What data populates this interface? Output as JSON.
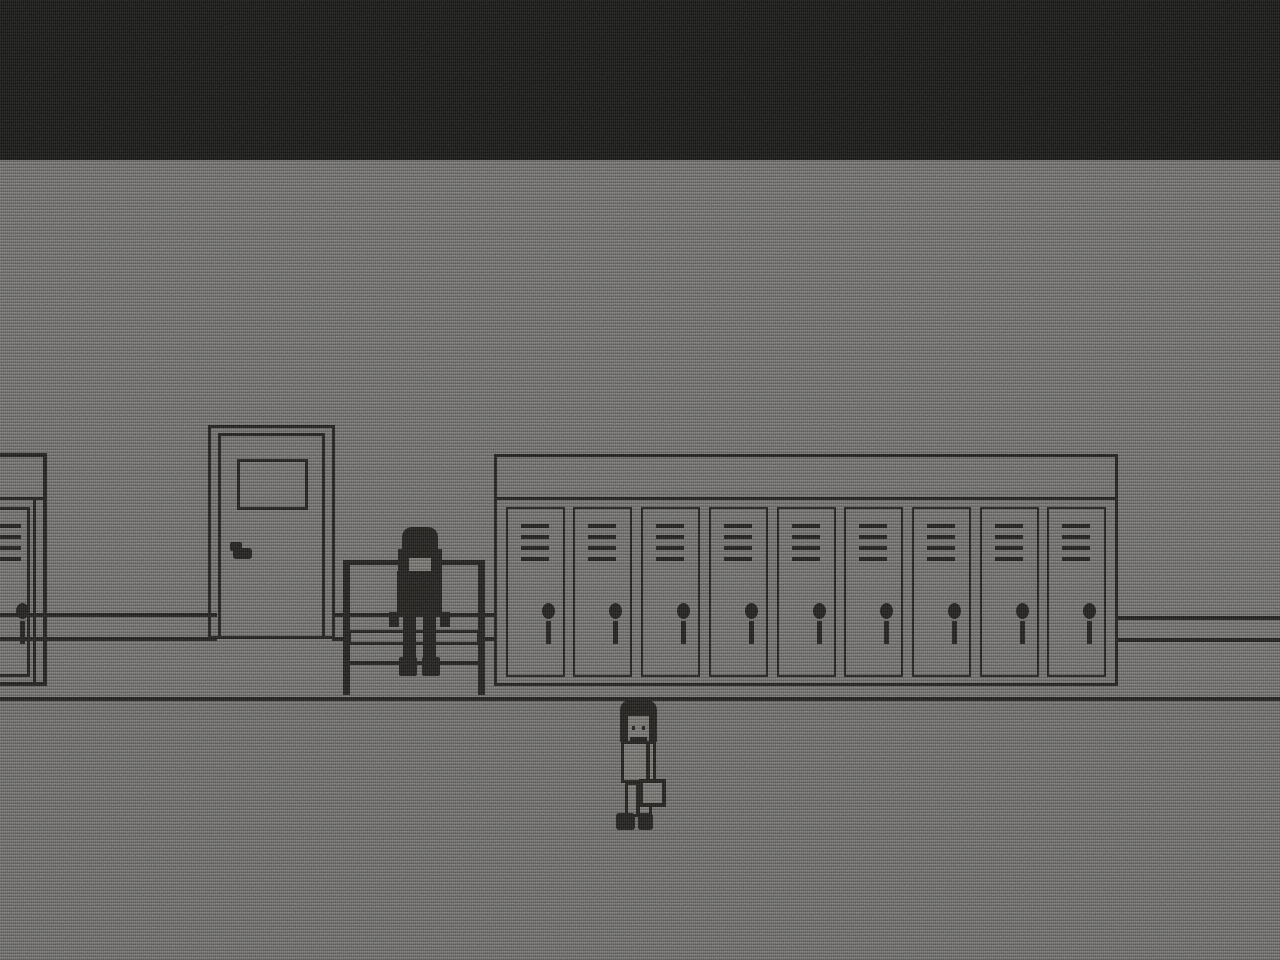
{
  "meta": {
    "domain": "game-screenshot",
    "style": "monochrome pixel-art hallway with CRT static and scanlines",
    "screen": "1280x960"
  },
  "palette": {
    "void": "#0f0f0e",
    "wall": "#6f6e6c",
    "floor": "#6c6b69",
    "line": "#171614",
    "sprite": "#757370"
  },
  "scene": {
    "ceiling": {
      "label": "dark static void"
    },
    "wall": {
      "label": "gray hallway wall"
    },
    "floor": {
      "label": "gray hallway floor"
    },
    "door": {
      "label": "door with small window and handle"
    },
    "lockers": {
      "label": "locker row",
      "door_count": 9,
      "vent_slats_per_door": 4
    },
    "left_locker": {
      "label": "partial locker at left screen edge",
      "door_count": 1
    },
    "bench": {
      "label": "bench with backrest"
    },
    "characters": [
      {
        "label": "seated figure",
        "pose": "sitting on bench",
        "hair": "long dark"
      },
      {
        "label": "standing figure",
        "pose": "standing in foreground",
        "accessory": "shoulder bag"
      }
    ]
  }
}
